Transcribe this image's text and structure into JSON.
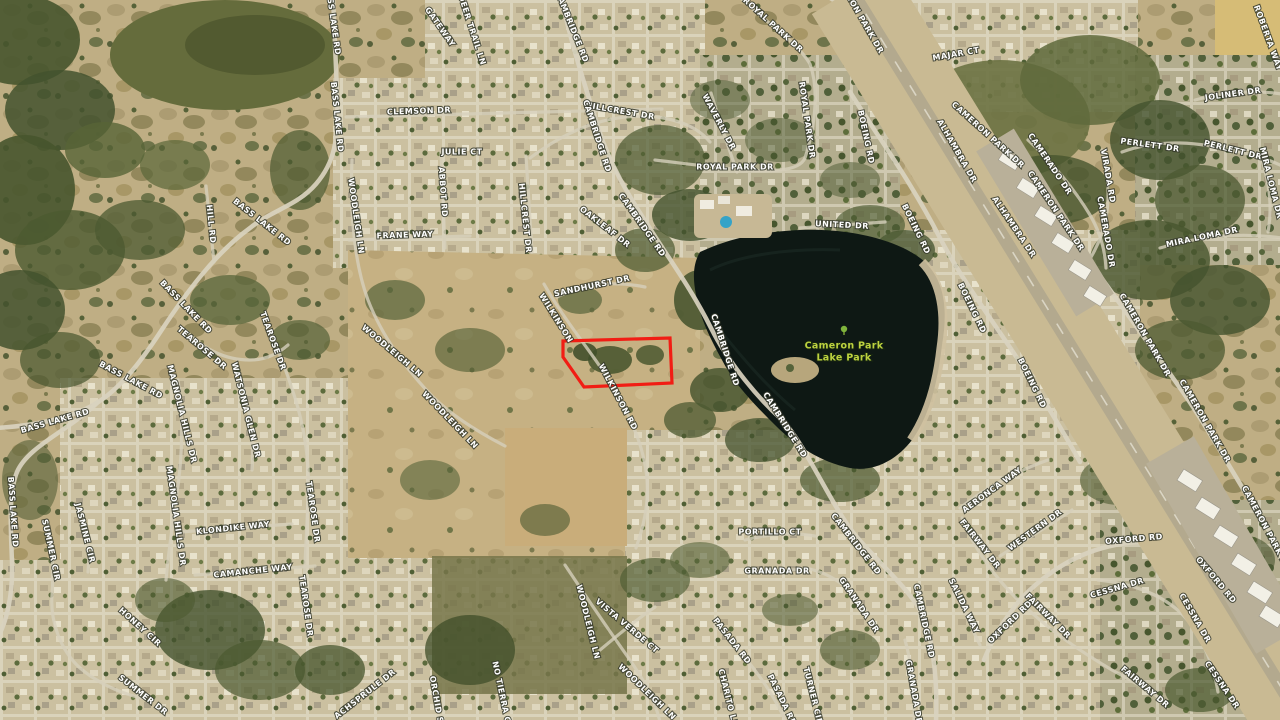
{
  "map": {
    "type": "satellite-aerial",
    "area_name": "Cameron Park",
    "lake_label": {
      "line1": "Cameron Park",
      "line2": "Lake Park",
      "color": "#bdd23f"
    },
    "parcel_outline": {
      "color": "#f11d14",
      "points": "563,341 670,338 672,383 584,387 563,357"
    },
    "label_style": {
      "color": "#ffffff",
      "halo": "#3c4032"
    },
    "labels": [
      {
        "t": "BASS LAKE RD",
        "x": 333,
        "y": 20,
        "r": 82
      },
      {
        "t": "BASS LAKE RD",
        "x": 337,
        "y": 117,
        "r": 84
      },
      {
        "t": "BASS LAKE RD",
        "x": 262,
        "y": 222,
        "r": 38
      },
      {
        "t": "BASS LAKE RD",
        "x": 186,
        "y": 307,
        "r": 46
      },
      {
        "t": "BASS LAKE RD",
        "x": 131,
        "y": 380,
        "r": 28
      },
      {
        "t": "BASS LAKE RD",
        "x": 55,
        "y": 421,
        "r": -16
      },
      {
        "t": "BASS LAKE RD",
        "x": 13,
        "y": 512,
        "r": 86
      },
      {
        "t": "HILL RD",
        "x": 211,
        "y": 224,
        "r": 84
      },
      {
        "t": "WOODLEIGH LN",
        "x": 356,
        "y": 216,
        "r": 82
      },
      {
        "t": "WOODLEIGH LN",
        "x": 392,
        "y": 351,
        "r": 40
      },
      {
        "t": "WOODLEIGH LN",
        "x": 450,
        "y": 420,
        "r": 46
      },
      {
        "t": "WOODLEIGH LN",
        "x": 588,
        "y": 622,
        "r": 76
      },
      {
        "t": "WOODLEIGH LN",
        "x": 647,
        "y": 692,
        "r": 44
      },
      {
        "t": "CLEMSON DR",
        "x": 419,
        "y": 111,
        "r": -2
      },
      {
        "t": "JULIE CT",
        "x": 462,
        "y": 152,
        "r": 0
      },
      {
        "t": "ABBOT RD",
        "x": 443,
        "y": 192,
        "r": 86
      },
      {
        "t": "FRANE WAY",
        "x": 405,
        "y": 235,
        "r": -2
      },
      {
        "t": "GATEWAY",
        "x": 440,
        "y": 27,
        "r": 55
      },
      {
        "t": "DEER TRAIL LN",
        "x": 472,
        "y": 30,
        "r": 72
      },
      {
        "t": "HILLCREST DR",
        "x": 620,
        "y": 111,
        "r": 10
      },
      {
        "t": "HILLCREST DR",
        "x": 525,
        "y": 218,
        "r": 84
      },
      {
        "t": "CAMBRIDGE RD",
        "x": 572,
        "y": 27,
        "r": 68
      },
      {
        "t": "CAMBRIDGE RD",
        "x": 597,
        "y": 136,
        "r": 72
      },
      {
        "t": "CAMBRIDGE RD",
        "x": 642,
        "y": 225,
        "r": 55
      },
      {
        "t": "CAMBRIDGE RD",
        "x": 725,
        "y": 350,
        "r": 72
      },
      {
        "t": "CAMBRIDGE RD",
        "x": 785,
        "y": 425,
        "r": 58
      },
      {
        "t": "CAMBRIDGE RD",
        "x": 856,
        "y": 544,
        "r": 52
      },
      {
        "t": "CAMBRIDGE RD",
        "x": 924,
        "y": 621,
        "r": 78
      },
      {
        "t": "OAKLEAF DR",
        "x": 605,
        "y": 227,
        "r": 38
      },
      {
        "t": "SANDHURST DR",
        "x": 592,
        "y": 286,
        "r": -12
      },
      {
        "t": "WILKINSON",
        "x": 556,
        "y": 318,
        "r": 58
      },
      {
        "t": "WILKINSON RD",
        "x": 618,
        "y": 397,
        "r": 62
      },
      {
        "t": "ROYAL PARK DR",
        "x": 773,
        "y": 25,
        "r": 42
      },
      {
        "t": "ROYAL PARK DR",
        "x": 807,
        "y": 120,
        "r": 82
      },
      {
        "t": "ROYAL PARK DR",
        "x": 735,
        "y": 167,
        "r": 0
      },
      {
        "t": "WAVERLY DR",
        "x": 719,
        "y": 122,
        "r": 62
      },
      {
        "t": "UNITED DR",
        "x": 842,
        "y": 225,
        "r": 3
      },
      {
        "t": "MAJAR CT",
        "x": 956,
        "y": 54,
        "r": -10
      },
      {
        "t": "BOEING RD",
        "x": 866,
        "y": 137,
        "r": 78
      },
      {
        "t": "BOEING RD",
        "x": 916,
        "y": 229,
        "r": 64
      },
      {
        "t": "BOEING RD",
        "x": 972,
        "y": 308,
        "r": 64
      },
      {
        "t": "BOEING RD",
        "x": 1032,
        "y": 383,
        "r": 64
      },
      {
        "t": "CAMERON PARK DR",
        "x": 858,
        "y": 12,
        "r": 60
      },
      {
        "t": "CAMERON PARK DR",
        "x": 988,
        "y": 135,
        "r": 42
      },
      {
        "t": "CAMERON PARK DR",
        "x": 1056,
        "y": 211,
        "r": 56
      },
      {
        "t": "CAMERON PARK DR",
        "x": 1145,
        "y": 335,
        "r": 60
      },
      {
        "t": "CAMERON PARK DR",
        "x": 1205,
        "y": 421,
        "r": 60
      },
      {
        "t": "CAMERON PARK DR",
        "x": 1266,
        "y": 528,
        "r": 62
      },
      {
        "t": "ALHAMBRA DR",
        "x": 957,
        "y": 151,
        "r": 60
      },
      {
        "t": "ALHAMBRA DR",
        "x": 1014,
        "y": 227,
        "r": 56
      },
      {
        "t": "CAMERADO DR",
        "x": 1050,
        "y": 164,
        "r": 56
      },
      {
        "t": "CAMERADO DR",
        "x": 1106,
        "y": 232,
        "r": 80
      },
      {
        "t": "VIRADA RD",
        "x": 1108,
        "y": 176,
        "r": 80
      },
      {
        "t": "PERLETT DR",
        "x": 1150,
        "y": 145,
        "r": 8
      },
      {
        "t": "PERLETT DR",
        "x": 1233,
        "y": 150,
        "r": 14
      },
      {
        "t": "JOLINER DR",
        "x": 1233,
        "y": 94,
        "r": -8
      },
      {
        "t": "ROBERTA WAY",
        "x": 1268,
        "y": 38,
        "r": 70
      },
      {
        "t": "MIRA LOMA DR",
        "x": 1271,
        "y": 183,
        "r": 76
      },
      {
        "t": "MIRA LOMA DR",
        "x": 1202,
        "y": 237,
        "r": -12
      },
      {
        "t": "OXFORD RD",
        "x": 1134,
        "y": 539,
        "r": -5
      },
      {
        "t": "OXFORD RD",
        "x": 1216,
        "y": 580,
        "r": 50
      },
      {
        "t": "OXFORD RD",
        "x": 1010,
        "y": 622,
        "r": -44
      },
      {
        "t": "FAIRWAY DR",
        "x": 980,
        "y": 544,
        "r": 52
      },
      {
        "t": "FAIRWAY DR",
        "x": 1048,
        "y": 616,
        "r": 45
      },
      {
        "t": "FAIRWAY DR",
        "x": 1145,
        "y": 687,
        "r": 40
      },
      {
        "t": "WESTERN DR",
        "x": 1035,
        "y": 530,
        "r": -36
      },
      {
        "t": "AERONCA WAY",
        "x": 992,
        "y": 490,
        "r": -36
      },
      {
        "t": "SALIDA WAY",
        "x": 964,
        "y": 606,
        "r": 64
      },
      {
        "t": "CESSNA DR",
        "x": 1117,
        "y": 588,
        "r": -16
      },
      {
        "t": "CESSNA DR",
        "x": 1195,
        "y": 618,
        "r": 60
      },
      {
        "t": "CESSNA DR",
        "x": 1222,
        "y": 685,
        "r": 56
      },
      {
        "t": "GRANADA DR",
        "x": 777,
        "y": 571,
        "r": 0
      },
      {
        "t": "GRANADA DR",
        "x": 859,
        "y": 605,
        "r": 56
      },
      {
        "t": "GRANADA DR",
        "x": 914,
        "y": 692,
        "r": 80
      },
      {
        "t": "PORTILLO CT",
        "x": 770,
        "y": 532,
        "r": 0
      },
      {
        "t": "PASADA RD",
        "x": 732,
        "y": 641,
        "r": 52
      },
      {
        "t": "PASADA RD",
        "x": 782,
        "y": 700,
        "r": 64
      },
      {
        "t": "CHARITO LN",
        "x": 728,
        "y": 698,
        "r": 76
      },
      {
        "t": "TURNER CIR",
        "x": 813,
        "y": 696,
        "r": 76
      },
      {
        "t": "VISTA VERDE CT",
        "x": 627,
        "y": 626,
        "r": 40
      },
      {
        "t": "KLONDIKE WAY",
        "x": 233,
        "y": 528,
        "r": -6
      },
      {
        "t": "CAMANCHE WAY",
        "x": 253,
        "y": 571,
        "r": -6
      },
      {
        "t": "JASMINE CIR",
        "x": 85,
        "y": 533,
        "r": 76
      },
      {
        "t": "MAGNOLIA HILLS DR",
        "x": 182,
        "y": 414,
        "r": 76
      },
      {
        "t": "MAGNOLIA HILLS DR",
        "x": 176,
        "y": 516,
        "r": 82
      },
      {
        "t": "WATSONIA GLEN DR",
        "x": 246,
        "y": 410,
        "r": 76
      },
      {
        "t": "TEAROSE DR",
        "x": 202,
        "y": 348,
        "r": 40
      },
      {
        "t": "TEAROSE DR",
        "x": 273,
        "y": 341,
        "r": 70
      },
      {
        "t": "TEAROSE DR",
        "x": 313,
        "y": 512,
        "r": 82
      },
      {
        "t": "TEAROSE DR",
        "x": 306,
        "y": 606,
        "r": 82
      },
      {
        "t": "SUMMER CIR",
        "x": 51,
        "y": 550,
        "r": 78
      },
      {
        "t": "SUMMER DR",
        "x": 143,
        "y": 695,
        "r": 38
      },
      {
        "t": "HONEY CIR",
        "x": 140,
        "y": 627,
        "r": 42
      },
      {
        "t": "ACHSPRULE DR",
        "x": 365,
        "y": 694,
        "r": -38
      },
      {
        "t": "ORCHID SH",
        "x": 437,
        "y": 703,
        "r": 80
      },
      {
        "t": "NO TIERRA CT",
        "x": 502,
        "y": 695,
        "r": 78
      }
    ]
  }
}
